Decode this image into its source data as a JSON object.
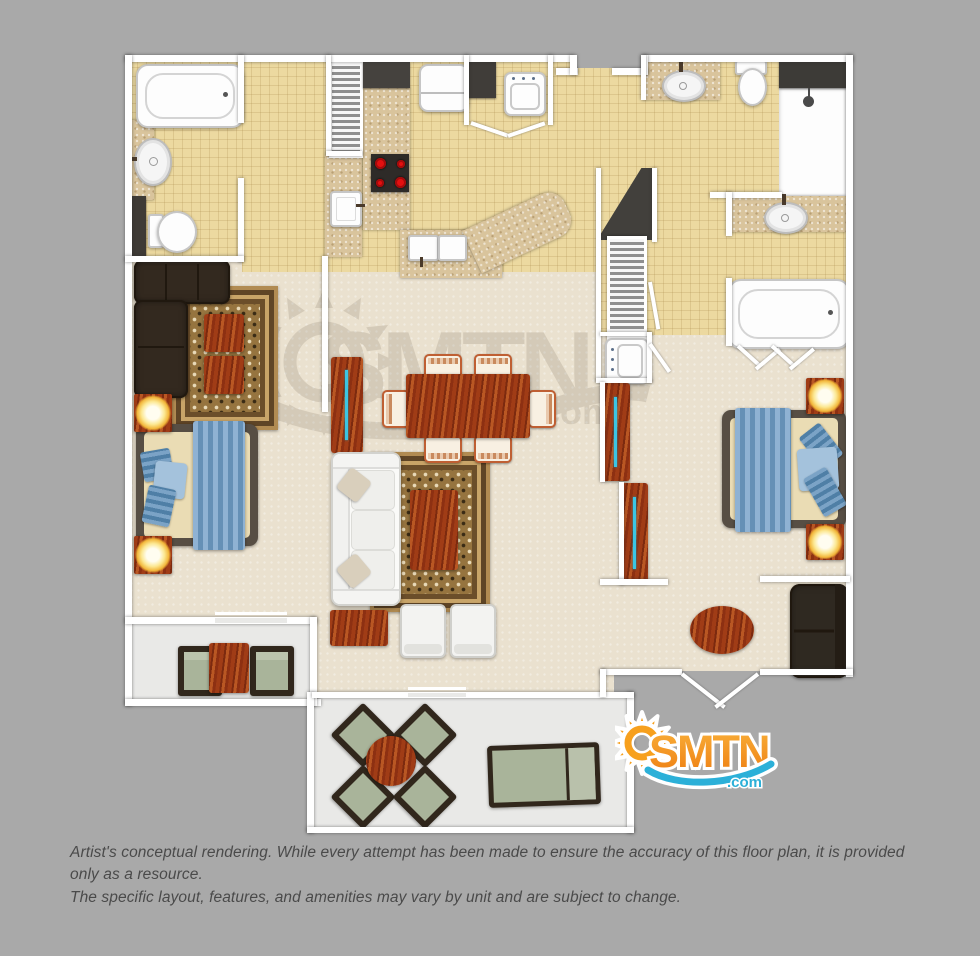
{
  "canvas": {
    "width": 980,
    "height": 956,
    "background": "#a9a9a9"
  },
  "watermark": {
    "text": "SMTN",
    "tld": ".com",
    "color": "#6b5f4d"
  },
  "logo": {
    "text": "SMTN",
    "tld": ".com",
    "orange": "#f6941d",
    "orange_light": "#f9b13a",
    "blue": "#2cb0d8"
  },
  "disclaimer": {
    "line1": "Artist's conceptual rendering. While every attempt has been made to ensure the accuracy of this floor plan, it is provided only as a resource.",
    "line2": "The specific layout, features, and amenities may vary by unit and are subject to change."
  },
  "palette": {
    "tile_floor": "#ecd9a0",
    "carpet_floor": "#eae1cf",
    "balcony_floor": "#e9e9e7",
    "granite_counter": "#d9c49c",
    "wood_dark": "#7c2a0f",
    "wood_light": "#b95723",
    "wall": "#ffffff",
    "dark_furniture": "#33291f",
    "bed_runner_blue": "#6590b6",
    "lamp_glow": "#f2b63a",
    "cushion_green": "#a9b49a",
    "stove_burner_red": "#e31010",
    "tv_screen_cyan": "#3bc5e4"
  },
  "fixtures_legend": [
    "bathtub",
    "pedestal-sink",
    "toilet",
    "shower-stall",
    "vanity-sink",
    "stove-cooktop",
    "refrigerator",
    "pantry-closet",
    "washer",
    "kitchen-sink",
    "stairs",
    "louvered-closet",
    "dining-table",
    "dining-chair",
    "sofa",
    "sectional-sofa",
    "loveseat",
    "armchair",
    "coffee-table",
    "console-table",
    "area-rug",
    "bed",
    "nightstand-lamp",
    "tv-dresser",
    "patio-table",
    "patio-chair",
    "chaise-lounge",
    "french-doors",
    "sliding-door"
  ]
}
